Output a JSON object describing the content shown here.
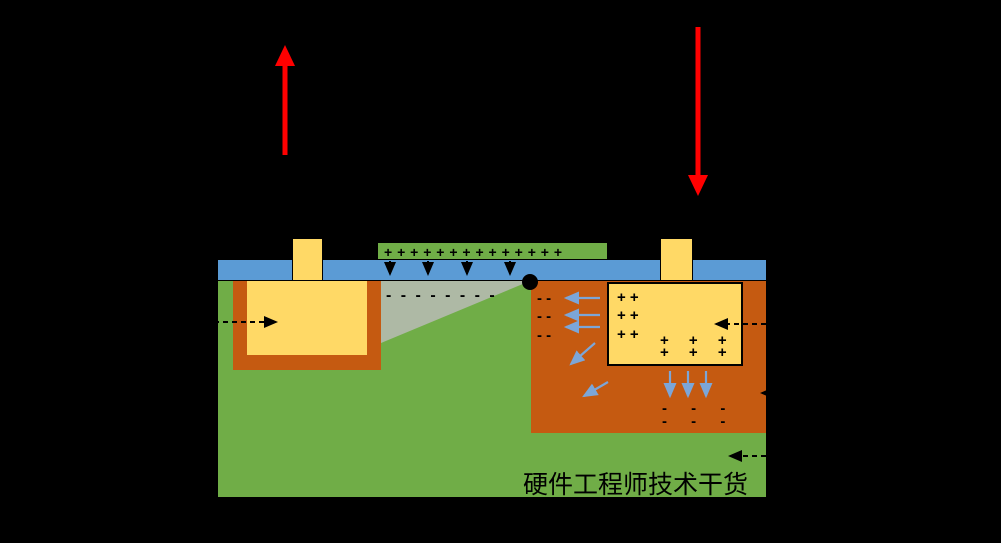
{
  "watermark": "硬件工程师技术干货",
  "colors": {
    "c-bg": "#000000",
    "c-green": "#70AD47",
    "c-blue": "#5B9BD5",
    "c-orange": "#C55A11",
    "c-yellow": "#FFD966",
    "c-gray": "#AEB9A5",
    "c-red": "#FF0000",
    "c-arrow-blue": "#7CA6D8",
    "c-black": "#000000"
  },
  "charges": {
    "gate_row": "+ + + + + + + + + + + + + +",
    "channel_row": "- - - - - - - -",
    "well_minus": [
      "- -",
      "- -",
      "- -"
    ],
    "drain_plus": [
      "+ +",
      "+ +",
      "+ +"
    ],
    "drain_plus_grid": [
      "+ + +",
      "+ + +"
    ],
    "well_bottom_minus": [
      "- - -",
      "- - -"
    ]
  },
  "icons": {
    "red_up_arrow": "upward red bias arrow",
    "red_down_arrow": "downward red bias arrow",
    "pinch_off_dot": "pinch-off point"
  }
}
